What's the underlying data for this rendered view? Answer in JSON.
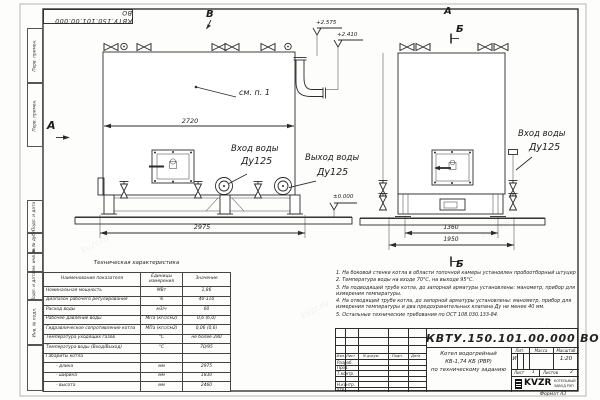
{
  "sheet": {
    "code_stamp": "КВТУ.150.101.00.000 ВО",
    "format_label": "Формат  А3",
    "side_strip": [
      "Перв. примен.",
      "Перв. примен.",
      "Подп. и дата",
      "Инв. № дубл.",
      "Взам. инв. №",
      "Подп. и дата",
      "Инв. № подл."
    ]
  },
  "watermark": "kvzr.ru",
  "views": {
    "top_view": "В",
    "front_view": "А",
    "section_top": "Б",
    "section_bottom": "Б",
    "side_arrow": "А",
    "see_note": "см. п. 1"
  },
  "dims": {
    "boiler_length_top": "2720",
    "boiler_length_overall": "2975",
    "frame_width": "1360",
    "width_overall": "1950"
  },
  "elevations": {
    "chimney_top": "+2.575",
    "outlet": "+2.410",
    "ground": "±0.000"
  },
  "ports": {
    "inlet_left": {
      "line1": "Вход воды",
      "line2": "Ду125"
    },
    "outlet": {
      "line1": "Выход воды",
      "line2": "Ду125"
    },
    "inlet_right": {
      "line1": "Вход воды",
      "line2": "Ду125"
    }
  },
  "tech_table": {
    "title": "Техническая характеристика",
    "headers": [
      "Наименование показателя",
      "Единицы измерения",
      "Значение"
    ],
    "rows": [
      [
        "Номинальная мощность",
        "МВт",
        "1,86"
      ],
      [
        "Диапазон рабочего регулирования",
        "%",
        "40-110"
      ],
      [
        "Расход воды",
        "м3/ч",
        "60"
      ],
      [
        "Рабочее давление воды",
        "МПа (кгс/см2)",
        "0,6 (6,0)"
      ],
      [
        "Гидравлическое сопротивление котла",
        "МПа (кгс/см2)",
        "0,06 (0,6)"
      ],
      [
        "Температура уходящих газов",
        "°С",
        "не более 280"
      ],
      [
        "Температура воды (Вход/Выход)",
        "°С",
        "70/95"
      ],
      [
        "Габариты котла",
        "",
        ""
      ],
      [
        "- длина",
        "мм",
        "2975"
      ],
      [
        "- ширина",
        "мм",
        "1830"
      ],
      [
        "- высота",
        "мм",
        "2460"
      ]
    ]
  },
  "notes": [
    "1.  На боковой стенке котла в области топочной камеры установлен пробоотборный штуцер",
    "2.  Температура воды на входе 70°С, на выходе 95°С.",
    "3.  На подводящей трубе котла, до запорной арматуры установлены: манометр, прибор для измерения температуры.",
    "4.  На отводящей трубе котла, до запорной арматуры установлены: манометр, прибор для измерения температуры и два предохранительных клапана Ду не менее 40 мм.",
    "5.  Остальные технические требования по ОСТ 108.030.133-84."
  ],
  "title_block": {
    "designation": "КВТУ.150.101.00.000  ВО",
    "product_line1": "Котел водогрейный",
    "product_line2": "КВ-1,74  КБ  (РВР)",
    "product_line3": "по техническому заданию",
    "col_izm": "Изм.",
    "col_list": "Лист",
    "col_doc": "N докум.",
    "col_podp": "Подп.",
    "col_data": "Дата",
    "row_razrab": "Разраб.",
    "row_prov": "Пров.",
    "row_tkontr": "Т.контр.",
    "row_nkontr": "Н.контр.",
    "row_utv": "Утв.",
    "lit_label": "Лит.",
    "mass_label": "Масса",
    "scale_label": "Масштаб",
    "lit_value": "И",
    "scale_value": "1:20",
    "sheet_label": "Лист",
    "sheet_value": "1",
    "sheets_label": "Листов",
    "sheets_value": "2",
    "logo": "KVZR",
    "logo_line1": "КОТЕЛЬНЫЙ",
    "logo_line2": "ЗАВОД РЭП"
  }
}
